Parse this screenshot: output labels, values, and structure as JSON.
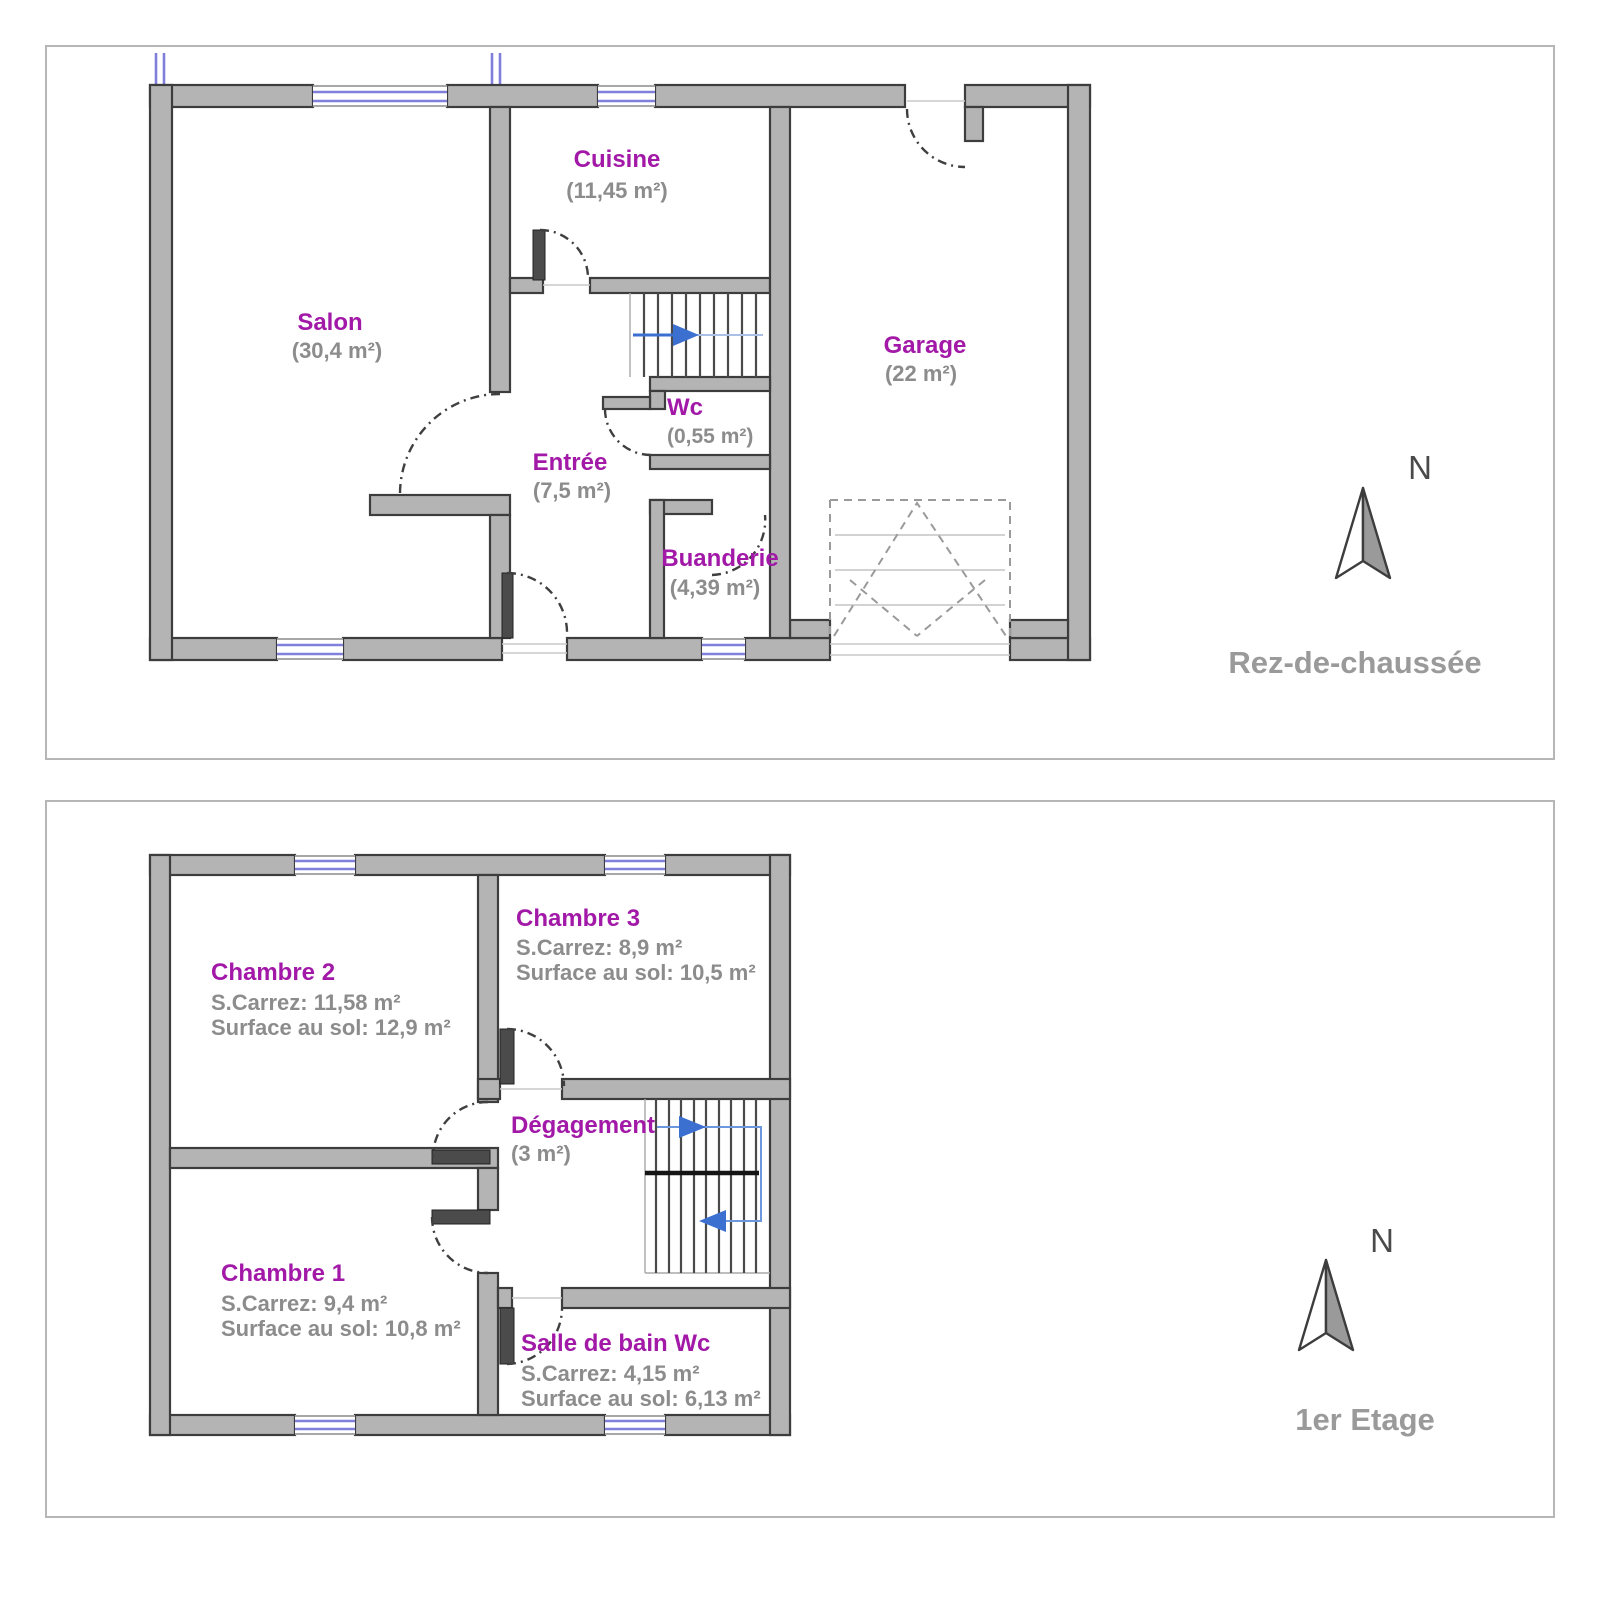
{
  "colors": {
    "wall_fill": "#b4b4b4",
    "wall_stroke": "#3d3d3d",
    "window_blue": "#8080dc",
    "room_label_purple": "#a219a8",
    "area_text_gray": "#8c8c8c",
    "caption_gray": "#9a9a9a",
    "stair_arrow_blue": "#3b6fd0",
    "stair_path_blue": "#6b97dd",
    "door_leaf": "#4b4b4b",
    "panel_border": "#b6b6b6"
  },
  "ground_floor": {
    "caption": "Rez-de-chaussée",
    "compass": "N",
    "rooms": {
      "cuisine": {
        "name": "Cuisine",
        "area": "(11,45 m²)"
      },
      "salon": {
        "name": "Salon",
        "area": "(30,4 m²)"
      },
      "garage": {
        "name": "Garage",
        "area": "(22 m²)"
      },
      "wc": {
        "name": "Wc",
        "area": "(0,55 m²)"
      },
      "entree": {
        "name": "Entrée",
        "area": "(7,5 m²)"
      },
      "buanderie": {
        "name": "Buanderie",
        "area": "(4,39 m²)"
      }
    }
  },
  "first_floor": {
    "caption": "1er Etage",
    "compass": "N",
    "rooms": {
      "chambre2": {
        "name": "Chambre 2",
        "carrez": "S.Carrez: 11,58 m²",
        "sol": "Surface au sol: 12,9 m²"
      },
      "chambre3": {
        "name": "Chambre 3",
        "carrez": "S.Carrez: 8,9 m²",
        "sol": "Surface au sol: 10,5 m²"
      },
      "degagement": {
        "name": "Dégagement",
        "area": "(3 m²)"
      },
      "chambre1": {
        "name": "Chambre 1",
        "carrez": "S.Carrez: 9,4 m²",
        "sol": "Surface au sol: 10,8 m²"
      },
      "sdb": {
        "name": "Salle de bain Wc",
        "carrez": "S.Carrez: 4,15 m²",
        "sol": "Surface au sol: 6,13 m²"
      }
    }
  }
}
